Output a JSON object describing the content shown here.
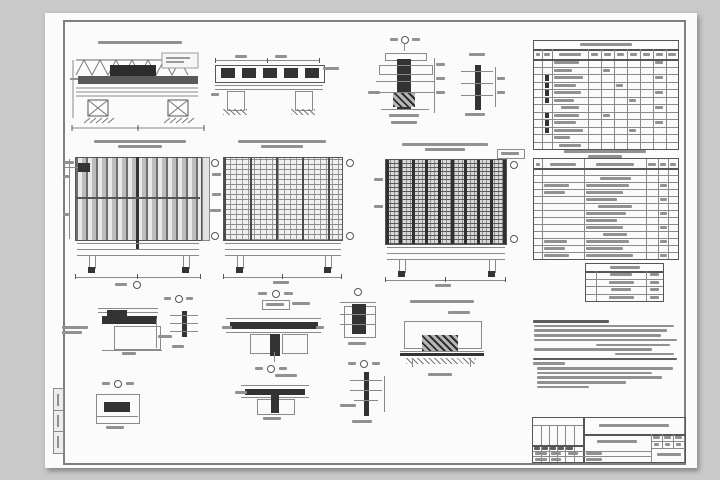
{
  "document": {
    "kind": "scanned structural engineering drawing sheet (GOST format, text illegible at scan resolution)"
  },
  "colors": {
    "background": "#c9c9c9",
    "paper": "#fbfbfb",
    "line_dark": "#555555",
    "line_light": "#8a8a8a",
    "text_smudge": "#919191",
    "fill_dark": "#333333"
  },
  "views": {
    "view-a": "truss-beam-elevation-with-supports",
    "view-b": "voided-slab-cross-section-on-supports",
    "view-c": "column-joint-vertical-section",
    "view-d": "edge-section-ladder-detail",
    "view-e": "panel-plan-vertical-ribs",
    "view-f": "panel-plan-reinforcement-mesh",
    "view-g": "panel-plan-dense-mesh",
    "details": [
      "node-h",
      "node-i",
      "node-j",
      "node-k",
      "node-l",
      "node-m",
      "node-n",
      "node-o"
    ]
  },
  "smudge_groups": {
    "title_a": {
      "cx": 95,
      "y": 28,
      "w": [
        84
      ]
    },
    "label_d": {
      "cx": 432,
      "y": 40,
      "w": [
        16
      ]
    },
    "title_e": {
      "cx": 95,
      "y": 127,
      "w": [
        92,
        44
      ]
    },
    "title_f": {
      "cx": 237,
      "y": 127,
      "w": [
        88,
        42
      ]
    },
    "title_g": {
      "cx": 400,
      "y": 130,
      "w": [
        86,
        40
      ]
    },
    "title_l": {
      "cx": 397,
      "y": 287,
      "w": [
        64
      ]
    },
    "title_steel": {
      "cx": 560,
      "y": 137,
      "w": [
        82,
        34
      ]
    }
  },
  "tables": {
    "spec_top": {
      "x": 488,
      "y": 27,
      "w": 144,
      "h": 108,
      "title_h": 8,
      "title_w": 52,
      "header_h": 10,
      "rows": 12,
      "colx": [
        8,
        18,
        54,
        67,
        80,
        93,
        106,
        119,
        132
      ],
      "darkmark_col": 1,
      "darkmarks": [
        2,
        3,
        4,
        5,
        7,
        8,
        9
      ],
      "smudges": [
        {
          "r": 0,
          "c": 2,
          "w": 0.7
        },
        {
          "r": 1,
          "c": 2,
          "w": 0.5
        },
        {
          "r": 2,
          "c": 2,
          "w": 0.8
        },
        {
          "r": 3,
          "c": 2,
          "w": 0.6
        },
        {
          "r": 4,
          "c": 2,
          "w": 0.75
        },
        {
          "r": 5,
          "c": 2,
          "w": 0.55
        },
        {
          "r": 6,
          "c": 2,
          "w": 0.5,
          "a": "c"
        },
        {
          "r": 7,
          "c": 2,
          "w": 0.7
        },
        {
          "r": 8,
          "c": 2,
          "w": 0.6
        },
        {
          "r": 9,
          "c": 2,
          "w": 0.8
        },
        {
          "r": 10,
          "c": 2,
          "w": 0.45
        },
        {
          "r": 11,
          "c": 2,
          "w": 0.6,
          "a": "c"
        },
        {
          "r": 0,
          "c": 8,
          "w": 0.6
        },
        {
          "r": 2,
          "c": 8,
          "w": 0.6
        },
        {
          "r": 4,
          "c": 8,
          "w": 0.6
        },
        {
          "r": 6,
          "c": 8,
          "w": 0.6
        },
        {
          "r": 8,
          "c": 8,
          "w": 0.6
        },
        {
          "r": 1,
          "c": 4,
          "w": 0.5
        },
        {
          "r": 3,
          "c": 5,
          "w": 0.5
        },
        {
          "r": 5,
          "c": 6,
          "w": 0.5
        },
        {
          "r": 7,
          "c": 4,
          "w": 0.5
        },
        {
          "r": 9,
          "c": 6,
          "w": 0.5
        }
      ]
    },
    "steel": {
      "x": 488,
      "y": 145,
      "w": 144,
      "h": 100,
      "title_h": 0,
      "header_h": 9,
      "rows": 13,
      "colx": [
        8,
        50,
        112,
        124,
        134
      ],
      "darkmark_col": -1,
      "darkmarks": [],
      "smudges": [
        {
          "r": 1,
          "c": 2,
          "w": 0.5,
          "a": "c"
        },
        {
          "r": 5,
          "c": 2,
          "w": 0.55,
          "a": "c"
        },
        {
          "r": 9,
          "c": 2,
          "w": 0.4,
          "a": "c"
        },
        {
          "r": 2,
          "c": 1,
          "w": 0.6
        },
        {
          "r": 2,
          "c": 2,
          "w": 0.7
        },
        {
          "r": 3,
          "c": 1,
          "w": 0.5
        },
        {
          "r": 3,
          "c": 2,
          "w": 0.6
        },
        {
          "r": 4,
          "c": 2,
          "w": 0.5
        },
        {
          "r": 6,
          "c": 2,
          "w": 0.65
        },
        {
          "r": 7,
          "c": 2,
          "w": 0.5
        },
        {
          "r": 8,
          "c": 2,
          "w": 0.6
        },
        {
          "r": 10,
          "c": 1,
          "w": 0.55
        },
        {
          "r": 10,
          "c": 2,
          "w": 0.7
        },
        {
          "r": 11,
          "c": 1,
          "w": 0.5
        },
        {
          "r": 11,
          "c": 2,
          "w": 0.6
        },
        {
          "r": 12,
          "c": 1,
          "w": 0.6
        },
        {
          "r": 12,
          "c": 2,
          "w": 0.75
        },
        {
          "r": 2,
          "c": 4,
          "w": 0.7
        },
        {
          "r": 4,
          "c": 4,
          "w": 0.7
        },
        {
          "r": 6,
          "c": 4,
          "w": 0.7
        },
        {
          "r": 8,
          "c": 4,
          "w": 0.7
        },
        {
          "r": 10,
          "c": 4,
          "w": 0.7
        },
        {
          "r": 12,
          "c": 4,
          "w": 0.7
        }
      ]
    },
    "mini": {
      "x": 540,
      "y": 250,
      "w": 77,
      "h": 37,
      "title_h": 7,
      "title_w": 30,
      "header_h": 0,
      "rows": 4,
      "colx": [
        10,
        60
      ],
      "darkmark_col": -1,
      "darkmarks": [],
      "smudges": [
        {
          "r": 0,
          "c": 1,
          "w": 0.45,
          "a": "c"
        },
        {
          "r": 1,
          "c": 1,
          "w": 0.5,
          "a": "c"
        },
        {
          "r": 2,
          "c": 1,
          "w": 0.4,
          "a": "c"
        },
        {
          "r": 3,
          "c": 1,
          "w": 0.5,
          "a": "c"
        },
        {
          "r": 0,
          "c": 2,
          "w": 0.5,
          "a": "c"
        },
        {
          "r": 1,
          "c": 2,
          "w": 0.5,
          "a": "c"
        },
        {
          "r": 2,
          "c": 2,
          "w": 0.5,
          "a": "c"
        },
        {
          "r": 3,
          "c": 2,
          "w": 0.5,
          "a": "c"
        }
      ]
    }
  },
  "notes": {
    "x": 485,
    "y": 307,
    "w": 147,
    "line_step": 4.7,
    "lines": [
      {
        "w": 0.52,
        "i": 0.02,
        "d": 1
      },
      {
        "w": 0.95,
        "i": 0.03
      },
      {
        "w": 0.9,
        "i": 0.03
      },
      {
        "w": 0.86,
        "i": 0.03
      },
      {
        "w": 0.97,
        "i": 0.03
      },
      {
        "w": 0.5,
        "i": 0.45
      },
      {
        "w": 0.8,
        "i": 0.03
      },
      {
        "w": 0.4,
        "i": 0.58
      },
      {
        "w": 0.98,
        "i": 0.02,
        "d": 1
      },
      {
        "w": 0.22,
        "i": 0.02
      },
      {
        "w": 0.92,
        "i": 0.05
      },
      {
        "w": 0.78,
        "i": 0.05
      },
      {
        "w": 0.85,
        "i": 0.05
      },
      {
        "w": 0.6,
        "i": 0.05
      },
      {
        "w": 0.35,
        "i": 0.05
      }
    ]
  }
}
